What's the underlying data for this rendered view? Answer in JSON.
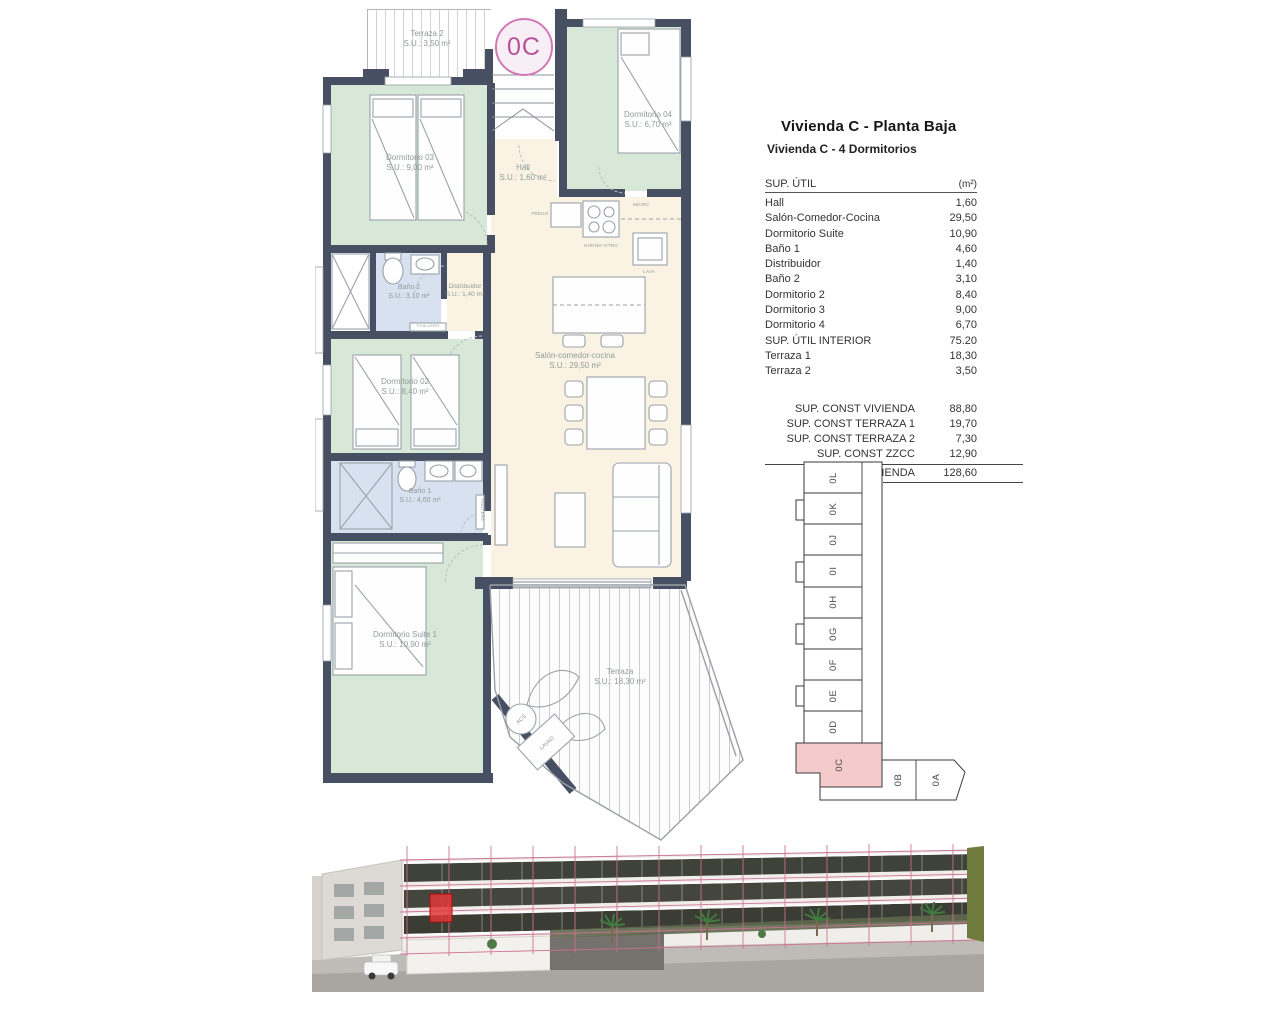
{
  "info_panel": {
    "title": "Vivienda C - Planta Baja",
    "subtitle": "Vivienda C - 4 Dormitorios",
    "table": {
      "header": {
        "label": "SUP. ÚTIL",
        "unit": "(m²)"
      },
      "rows": [
        {
          "label": "Hall",
          "value": "1,60"
        },
        {
          "label": "Salón-Comedor-Cocina",
          "value": "29,50"
        },
        {
          "label": "Dormitorio Suite",
          "value": "10,90"
        },
        {
          "label": "Baño 1",
          "value": "4,60"
        },
        {
          "label": "Distribuidor",
          "value": "1,40"
        },
        {
          "label": "Baño 2",
          "value": "3,10"
        },
        {
          "label": "Dormitorio 2",
          "value": "8,40"
        },
        {
          "label": "Dormitorio 3",
          "value": "9,00"
        },
        {
          "label": "Dormitorio 4",
          "value": "6,70"
        },
        {
          "label": "SUP. ÚTIL INTERIOR",
          "value": "75.20"
        },
        {
          "label": "Terraza 1",
          "value": "18,30"
        },
        {
          "label": "Terraza 2",
          "value": "3,50"
        }
      ],
      "totals": [
        {
          "label": "SUP. CONST VIVIENDA",
          "value": "88,80"
        },
        {
          "label": "SUP. CONST TERRAZA 1",
          "value": "19,70"
        },
        {
          "label": "SUP. CONST TERRAZA 2",
          "value": "7,30"
        },
        {
          "label": "SUP. CONST ZZCC",
          "value": "12,90"
        },
        {
          "label": "TOTAL VIVIENDA",
          "value": "128,60"
        }
      ]
    }
  },
  "floor_plan": {
    "unit_badge": "0C",
    "rooms": {
      "terraza2": {
        "name": "Terraza 2",
        "area": "S.U.: 3,50 m²"
      },
      "dormitorio03": {
        "name": "Dormitorio 03",
        "area": "S.U.: 9,00 m²"
      },
      "dormitorio04": {
        "name": "Dormitorio 04",
        "area": "S.U.: 6,70 m²"
      },
      "hall": {
        "name": "Hall",
        "area": "S.U.: 1,60 m²"
      },
      "bano2": {
        "name": "Baño 2",
        "area": "S.U.: 3,10 m²"
      },
      "distribuidor": {
        "name": "Distribuidor",
        "area": "S.U.: 1,40 m²"
      },
      "dormitorio02": {
        "name": "Dormitorio 02",
        "area": "S.U.: 8,40 m²"
      },
      "salon": {
        "name": "Salón-comedor-cocina",
        "area": "S.U.: 29,50 m²"
      },
      "bano1": {
        "name": "Baño 1",
        "area": "S.U.: 4,60 m²"
      },
      "suite": {
        "name": "Dormitorio Suite 1",
        "area": "S.U.: 10,90 m²"
      },
      "terraza": {
        "name": "Terraza",
        "area": "S.U.: 18,30 m²"
      }
    },
    "fixtures": {
      "frego": "FREGO",
      "micro": "MICRO",
      "horno": "HORNO VITRO",
      "lava": "LAVA",
      "toallero": "TOALLERO",
      "acs": "ACS",
      "lavad": "LAVAD"
    }
  },
  "key_plan": {
    "units": [
      "0L",
      "0K",
      "0J",
      "0I",
      "0H",
      "0G",
      "0F",
      "0E",
      "0D"
    ],
    "highlighted_unit": "0C",
    "bottom_units": [
      "0B",
      "0A"
    ]
  },
  "colors": {
    "wall": "#475063",
    "bedroom": "#d7e7d8",
    "bathroom": "#d8e1ef",
    "living": "#faf3e3",
    "badge_pink": "#b9509b",
    "keyplan_highlight": "#f5caca",
    "render_grid": "#d06f94"
  }
}
